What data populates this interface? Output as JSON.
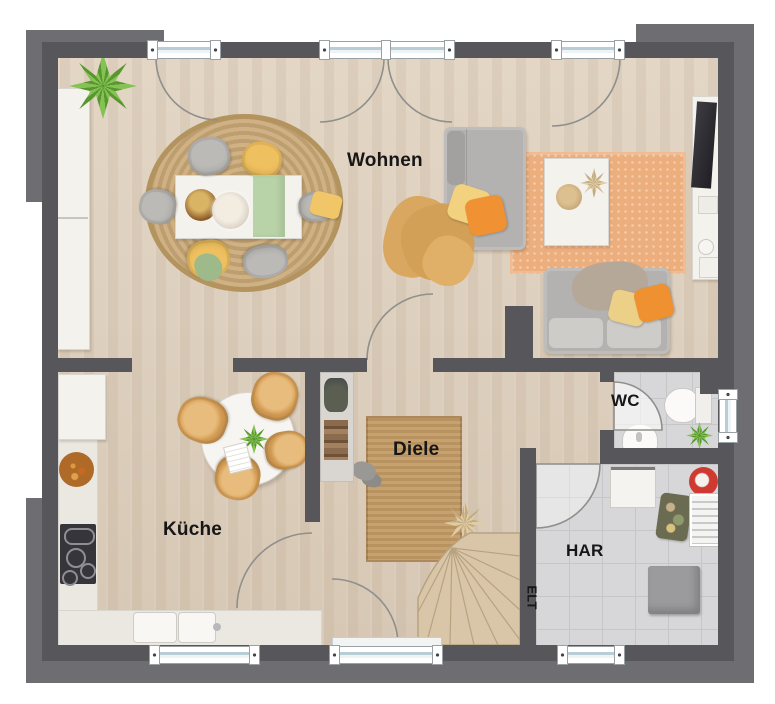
{
  "rooms": [
    {
      "id": "wohnen",
      "label": "Wohnen"
    },
    {
      "id": "kueche",
      "label": "Küche"
    },
    {
      "id": "diele",
      "label": "Diele"
    },
    {
      "id": "wc",
      "label": "WC"
    },
    {
      "id": "har",
      "label": "HAR"
    },
    {
      "id": "elt",
      "label": "ELT"
    }
  ],
  "palette": {
    "wall": "#57575b",
    "wall_shadow": "#6d6d72",
    "wood_floor": "#ddcfbd",
    "tile_floor": "#d7d7d9",
    "counter": "#ebe8e2",
    "jute_rug": "#c8a87c",
    "orange_rug": "#ecae7d",
    "hall_rug": "#c29c6b",
    "stairs": "#d9c6a8",
    "sofa_gray": "#b3b2b0",
    "accent_orange": "#f09133",
    "accent_yellow": "#eec05f",
    "accent_sage": "#b9d3a8",
    "plant_green": "#6faa3c",
    "label_color": "#161616"
  },
  "furniture": {
    "wohnen": [
      "potted-palm",
      "tall-cabinet",
      "round-jute-rug",
      "dining-table",
      "table-runner",
      "six-chairs",
      "daybed",
      "throw-blanket",
      "pillows",
      "orange-rug",
      "coffee-table",
      "tv-sideboard",
      "loveseat"
    ],
    "kueche": [
      "fridge",
      "kitchen-counter",
      "cooktop",
      "fruit-bowl",
      "sink-counter",
      "round-table",
      "four-chairs",
      "table-plant"
    ],
    "diele": [
      "wardrobe-niche",
      "hall-rug",
      "slippers",
      "dried-plant",
      "winder-stairs",
      "entrance-door"
    ],
    "wc": [
      "toilet",
      "cistern",
      "washbasin",
      "plant",
      "window"
    ],
    "har": [
      "washing-machine",
      "vacuum",
      "laundry-basket",
      "drying-rack",
      "storage-box"
    ]
  }
}
